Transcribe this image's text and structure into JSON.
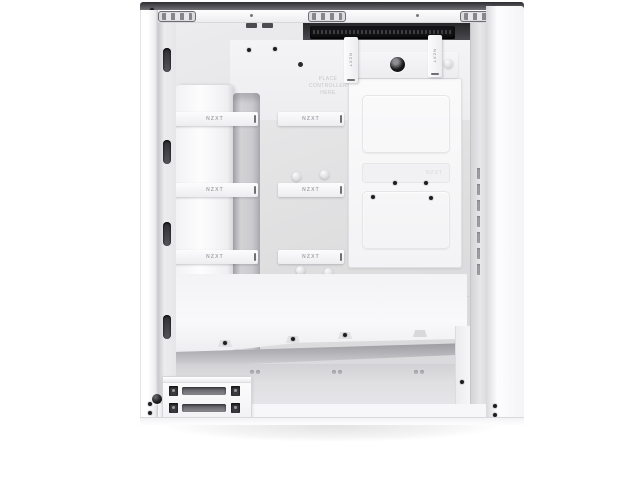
{
  "image": {
    "type": "product-photo",
    "subject": "White mid-tower PC case, side panel removed, interior cable-management view",
    "background": "#ffffff"
  },
  "brand": {
    "name": "NZXT"
  },
  "labels": {
    "strap": "NZXT",
    "strap_vertical": "NZXT",
    "embossed_logo": "NZXT",
    "controller_note": {
      "line1": "PLACE",
      "line2": "CONTROLLER",
      "line3": "HERE"
    }
  },
  "colors": {
    "case_white": "#f7f7f9",
    "interior_gray": "#e4e4e6",
    "recess_dark": "#1c1c1e",
    "channel_gray": "#c3c3c7",
    "shadow": "rgba(40,40,45,0.13)"
  }
}
